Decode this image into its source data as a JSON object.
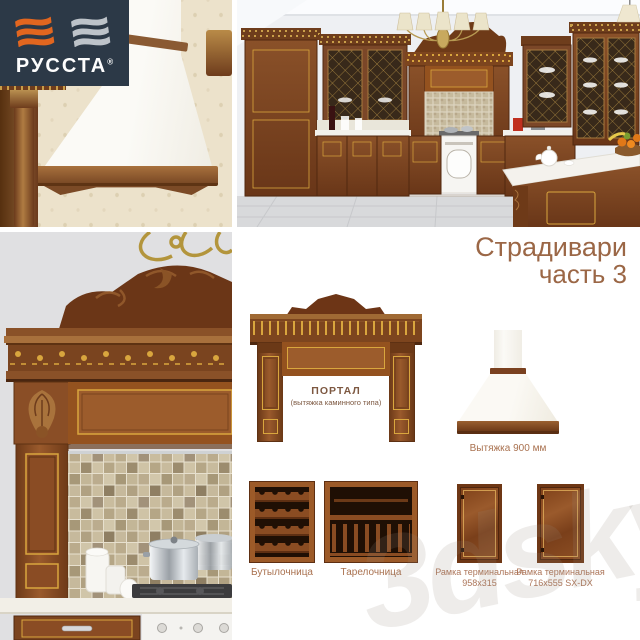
{
  "brand": {
    "name": "РУССТА",
    "registered_mark": "®",
    "colors": {
      "background": "#2c3947",
      "flag_left": "#e2661f",
      "flag_right": "#bdc3c9",
      "text": "#ffffff"
    }
  },
  "title": {
    "line1": "Страдивари",
    "line2": "часть 3",
    "color": "#9b6746"
  },
  "products": {
    "portal": {
      "name_line1": "ПОРТАЛ",
      "name_line2": "(вытяжка каминного типа)"
    },
    "hood": {
      "caption": "Вытяжка 900 мм"
    },
    "bottle_rack": {
      "caption": "Бутылочница"
    },
    "plate_rack": {
      "caption": "Тарелочница"
    },
    "frame_terminal_small": {
      "caption_line1": "Рамка терминальная",
      "caption_line2": "958х315"
    },
    "frame_terminal_large": {
      "caption_line1": "Рамка терминальная",
      "caption_line2": "716х555 SX-DX"
    }
  },
  "watermark": {
    "text": "3dsky"
  },
  "palette": {
    "wood": "#8a4c22",
    "wood_dark": "#6b3615",
    "gold": "#d9a63e",
    "caption_text": "#ad765a"
  }
}
